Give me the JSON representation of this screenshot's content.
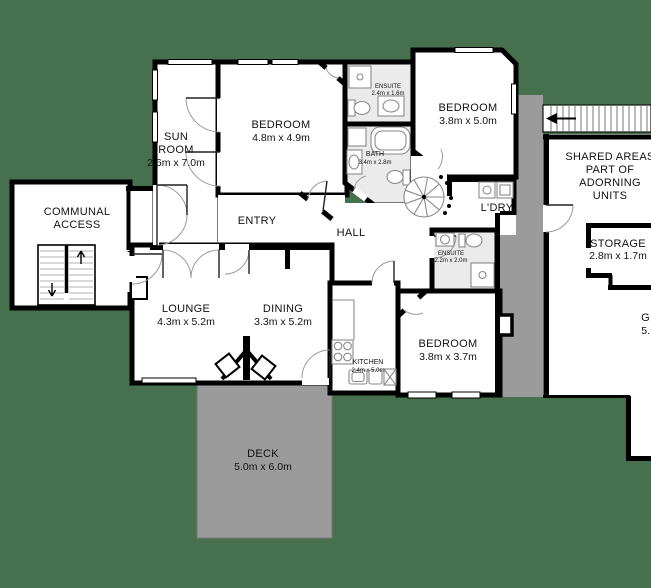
{
  "title": "Residential unit floor plan",
  "colors": {
    "ground": "#47704E",
    "wall": "#000000",
    "floor": "#FFFFFF",
    "wet_floor": "#EBEBEB",
    "deck": "#9B9B9B",
    "shared_corridor": "#9B9B9B",
    "fixture_stroke": "#8A8A8A"
  },
  "rooms": {
    "sun_room": {
      "line1": "SUN",
      "line2": "ROOM",
      "dims": "2.6m x 7.0m"
    },
    "bedroom_1": {
      "line1": "BEDROOM",
      "dims": "4.8m x 4.9m"
    },
    "ensuite_1": {
      "line1": "ENSUITE",
      "dims": "2.4m x 1.6m"
    },
    "bath": {
      "line1": "BATH",
      "dims": "3.4m x 2.8m"
    },
    "bedroom_2": {
      "line1": "BEDROOM",
      "dims": "3.8m x 5.0m"
    },
    "laundry": {
      "line1": "L'DRY"
    },
    "entry": {
      "line1": "ENTRY"
    },
    "hall": {
      "line1": "HALL"
    },
    "communal_access": {
      "line1": "COMMUNAL",
      "line2": "ACCESS"
    },
    "lounge": {
      "line1": "LOUNGE",
      "dims": "4.3m x 5.2m"
    },
    "dining": {
      "line1": "DINING",
      "dims": "3.3m x 5.2m"
    },
    "kitchen": {
      "line1": "KITCHEN",
      "dims": "2.4m x 5.0m"
    },
    "bedroom_3": {
      "line1": "BEDROOM",
      "dims": "3.8m x 3.7m"
    },
    "ensuite_2": {
      "line1": "ENSUITE",
      "dims": "2.2m x 2.0m"
    },
    "deck": {
      "line1": "DECK",
      "dims": "5.0m x 6.0m"
    },
    "storage": {
      "line1": "STORAGE",
      "dims": "2.8m x 1.7m"
    },
    "shared_note": {
      "line1": "SHARED AREAS",
      "line2": "PART OF",
      "line3": "ADORNING",
      "line4": "UNITS"
    },
    "clipped_room": {
      "line1": "G",
      "dims": "5."
    }
  }
}
